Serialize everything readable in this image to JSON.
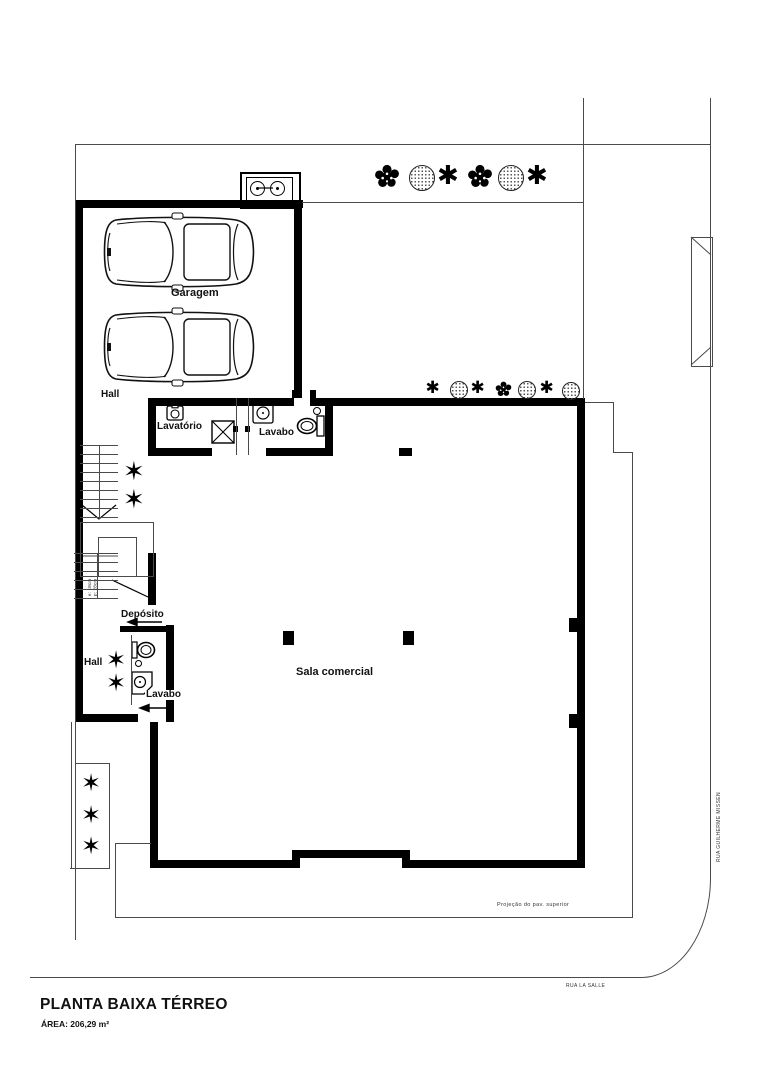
{
  "header": {
    "title": "PLANTA BAIXA TÉRREO",
    "area_label": "ÁREA: 206,29 m²"
  },
  "streets": {
    "right_street": "RUA GUILHERME MISSEN",
    "bottom_street": "RUA LA SALLE"
  },
  "rooms": {
    "garage": "Garagem",
    "hall_upper": "Hall",
    "lavatory": "Lavatório",
    "lavabo_upper": "Lavabo",
    "deposit": "Depósito",
    "hall_lower": "Hall",
    "lavabo_lower": "Lavabo",
    "commercial": "Sala comercial"
  },
  "annotations": {
    "upper_floor_projection": "Projeção do pav. superior",
    "stair_note_line1": "e: 18cm",
    "stair_note_line2": "p: 28cm"
  },
  "icons": {
    "asterisk_plant_glyph": "✱",
    "star_plant_glyph": "✶"
  },
  "colors": {
    "wall": "#000000",
    "thin_line": "#4a4a4a",
    "text": "#111111"
  },
  "plants": [
    {
      "type": "bush",
      "x": 387,
      "y": 177,
      "size": 26
    },
    {
      "type": "canopy",
      "x": 421,
      "y": 177,
      "size": 24
    },
    {
      "type": "aster",
      "x": 450,
      "y": 177,
      "size": 26
    },
    {
      "type": "bush",
      "x": 480,
      "y": 177,
      "size": 26
    },
    {
      "type": "canopy",
      "x": 510,
      "y": 177,
      "size": 24
    },
    {
      "type": "aster",
      "x": 539,
      "y": 177,
      "size": 26
    },
    {
      "type": "aster",
      "x": 434,
      "y": 389,
      "size": 17
    },
    {
      "type": "canopy",
      "x": 458,
      "y": 389,
      "size": 16
    },
    {
      "type": "aster",
      "x": 479,
      "y": 389,
      "size": 17
    },
    {
      "type": "bush",
      "x": 503,
      "y": 389,
      "size": 17
    },
    {
      "type": "canopy",
      "x": 526,
      "y": 389,
      "size": 16
    },
    {
      "type": "aster",
      "x": 548,
      "y": 389,
      "size": 17
    },
    {
      "type": "canopy",
      "x": 570,
      "y": 390,
      "size": 16
    },
    {
      "type": "star",
      "x": 136,
      "y": 473,
      "size": 26
    },
    {
      "type": "star",
      "x": 136,
      "y": 501,
      "size": 26
    },
    {
      "type": "star",
      "x": 118,
      "y": 661,
      "size": 24
    },
    {
      "type": "star",
      "x": 118,
      "y": 684,
      "size": 24
    },
    {
      "type": "star",
      "x": 93,
      "y": 784,
      "size": 24
    },
    {
      "type": "star",
      "x": 93,
      "y": 816,
      "size": 24
    },
    {
      "type": "star",
      "x": 93,
      "y": 847,
      "size": 24
    }
  ]
}
